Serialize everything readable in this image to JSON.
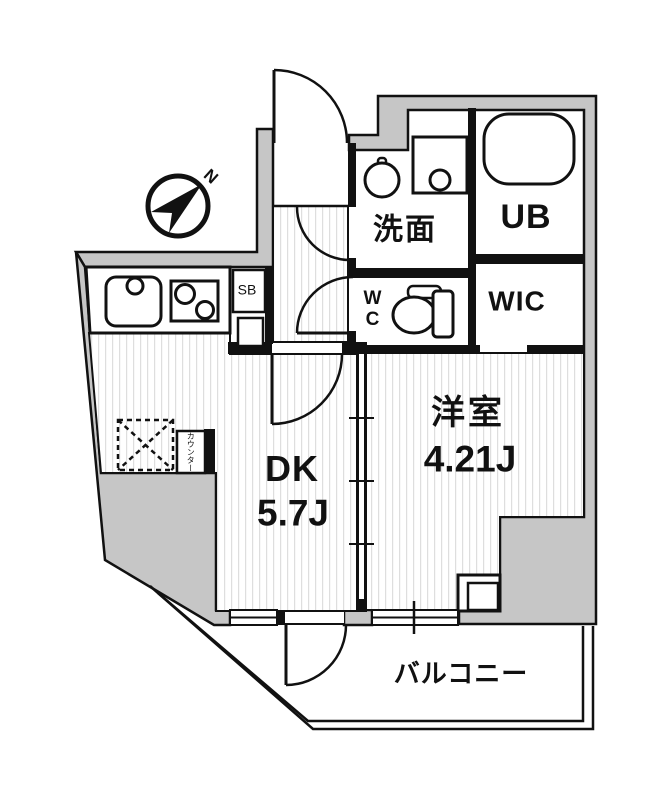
{
  "floorplan": {
    "title": "1DK apartment floor plan",
    "compass_label": "N",
    "rooms": {
      "senmen": "洗面",
      "ub": "UB",
      "wic": "WIC",
      "wc_line1": "W",
      "wc_line2": "C",
      "dk_name": "DK",
      "dk_size": "5.7J",
      "western_name": "洋室",
      "western_size": "4.21J",
      "balcony": "バルコニー",
      "shoe_box": "SB",
      "counter": "カウンター"
    },
    "colors": {
      "wall_gray": "#c6c6c6",
      "line_black": "#111111",
      "floor_stripe": "#dedede"
    }
  }
}
